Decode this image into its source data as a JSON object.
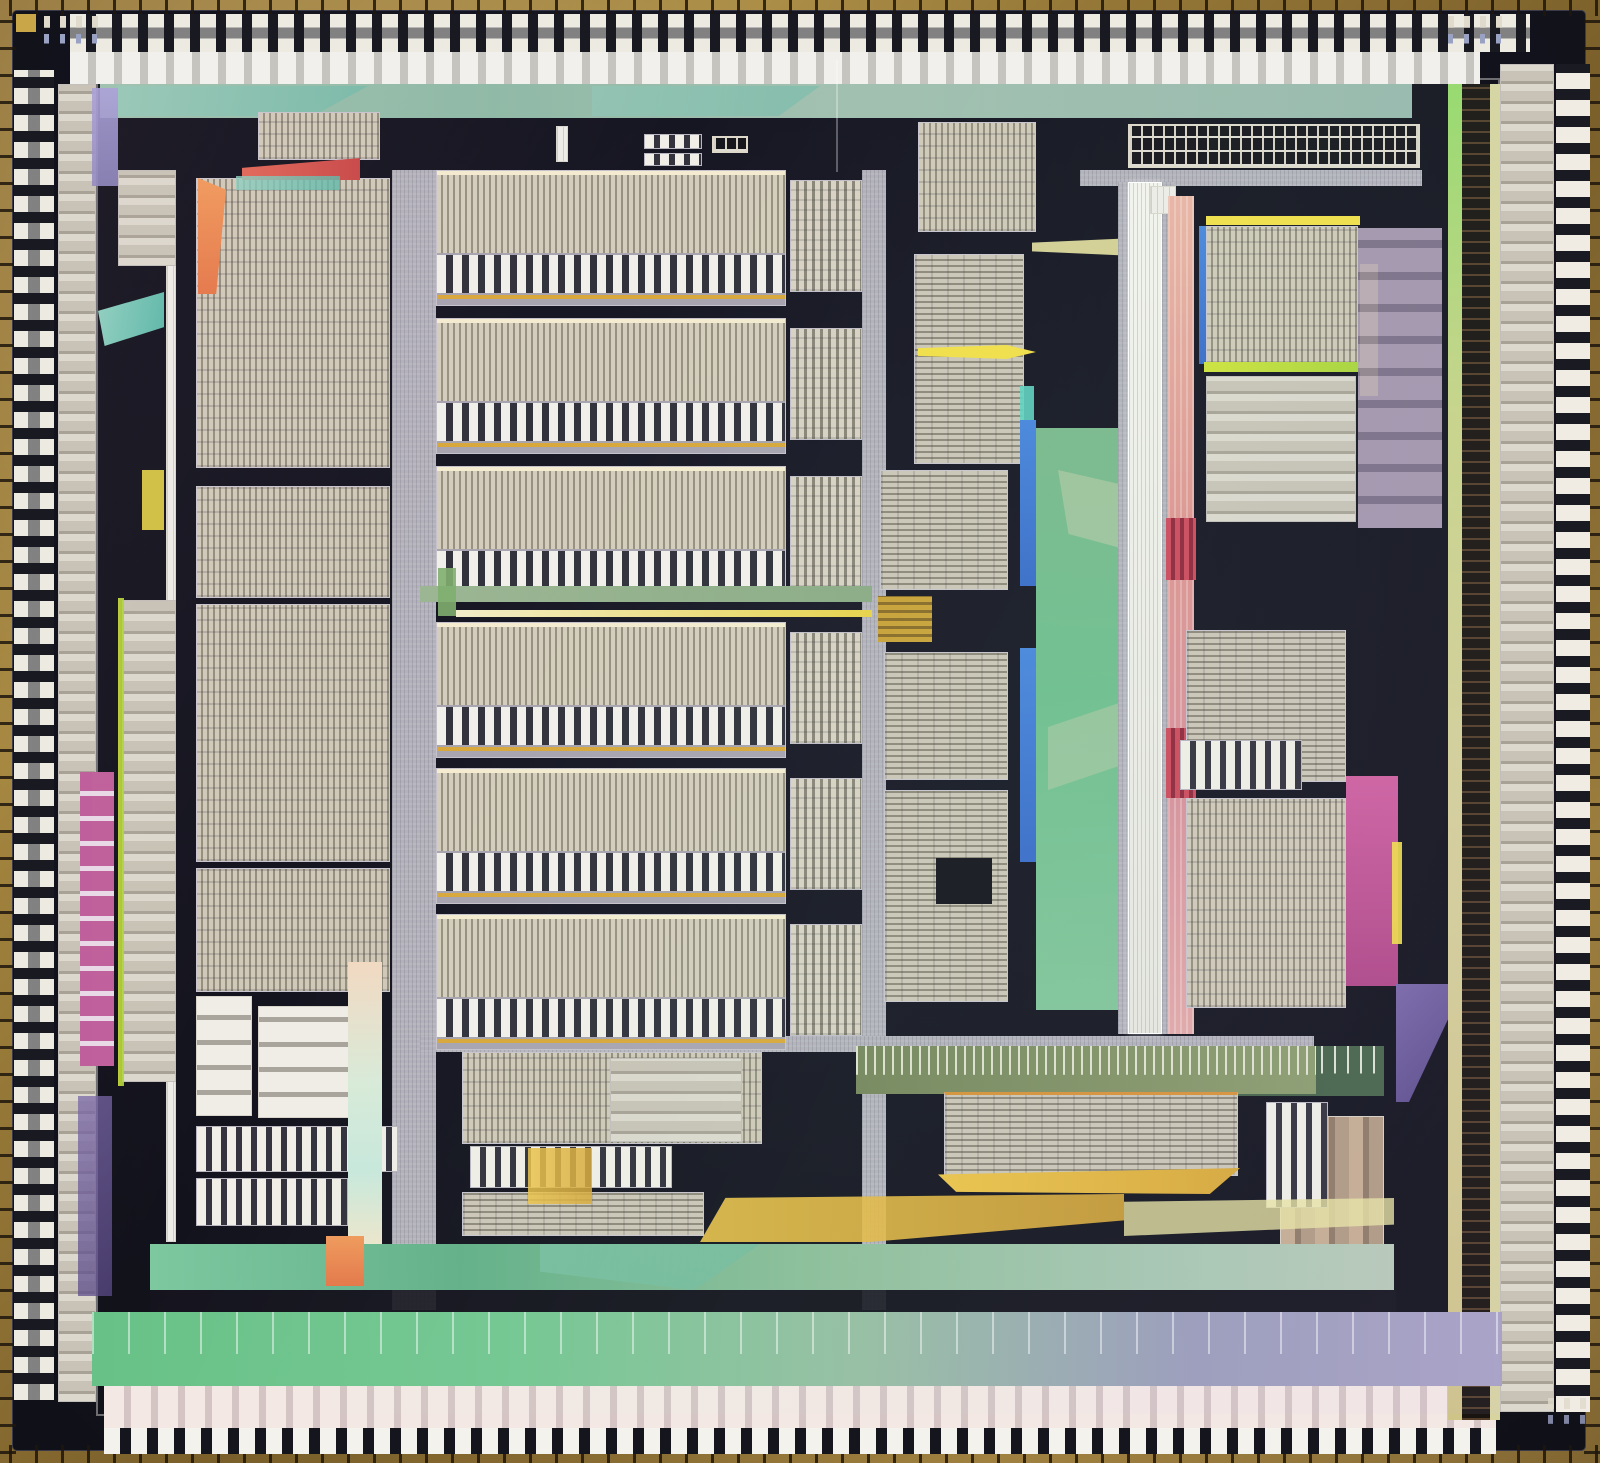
{
  "meta": {
    "alt": "Color photomicrograph of a microprocessor integrated-circuit die: gold chip edge with bond wires, perimeter bond-pad ring, dark substrate, rows of striped datapath and array blocks, a bright white vertical bus spine, and iridescent green, magenta, yellow and blue thin-film regions"
  },
  "palette": {
    "edge_gold": "#8a6d35",
    "die_dark": "#14141f",
    "block_tan": "#cdc6b6",
    "stripe_dark": "#8f897b",
    "channel_gray": "#b3b1bb",
    "spine_white": "#f2f1ec",
    "green": "#6fbe8e",
    "teal": "#5cb8a8",
    "sage": "#9cb694",
    "magenta": "#b0548c",
    "salmon": "#e09890",
    "crimson": "#cc4a5c",
    "yellow": "#f2df4a",
    "gold": "#d8a83a",
    "chartreuse": "#cfe23c",
    "orange": "#f09a5c",
    "blue": "#3f7bd9",
    "lavender": "#a8a0d8",
    "purple": "#6f5d9c",
    "olive": "#7a8a5c",
    "khaki": "#cfd98c",
    "pad_white": "#edeae2",
    "bond_wire": "#241c12"
  },
  "regions": [
    {
      "n": "top-power-band",
      "x": 100,
      "y": 84,
      "w": 1312,
      "h": 34,
      "c": "w-topband"
    },
    {
      "n": "top-band-facet",
      "x": 118,
      "y": 86,
      "w": 250,
      "h": 30,
      "c": "w-teal",
      "op": 0.45,
      "clip": "polygon(0 0,100% 0,78% 100%,0 100%)"
    },
    {
      "n": "top-band-facet",
      "x": 592,
      "y": 86,
      "w": 228,
      "h": 30,
      "c": "w-teal",
      "op": 0.4,
      "clip": "polygon(0 0,100% 0,82% 100%,0 100%)"
    },
    {
      "n": "left-inner-column",
      "x": 58,
      "y": 84,
      "w": 38,
      "h": 1318,
      "c": "t-cells"
    },
    {
      "n": "right-inner-column",
      "x": 1500,
      "y": 64,
      "w": 54,
      "h": 1348,
      "c": "t-cells"
    },
    {
      "n": "left-center-channel",
      "x": 392,
      "y": 170,
      "w": 44,
      "h": 1140,
      "c": "t-chan"
    },
    {
      "n": "center-right-channel",
      "x": 862,
      "y": 170,
      "w": 24,
      "h": 1140,
      "c": "t-chan"
    },
    {
      "n": "top-right-bar",
      "x": 1080,
      "y": 170,
      "w": 342,
      "h": 16,
      "c": "t-chan"
    },
    {
      "n": "bottom-channel",
      "x": 420,
      "y": 1036,
      "w": 894,
      "h": 16,
      "c": "t-chan"
    },
    {
      "n": "khaki-bus-left",
      "x": 1448,
      "y": 84,
      "w": 14,
      "h": 1336,
      "c": "t-khaki"
    },
    {
      "n": "right-dark-column",
      "x": 1462,
      "y": 84,
      "w": 28,
      "h": 1336,
      "c": "t-darkwire"
    },
    {
      "n": "khaki-bus-right",
      "x": 1490,
      "y": 84,
      "w": 10,
      "h": 1336,
      "c": "w-khaki2"
    },
    {
      "n": "left-bus-line",
      "x": 166,
      "y": 170,
      "w": 10,
      "h": 1072,
      "c": "t-white"
    },
    {
      "n": "cell-block",
      "x": 118,
      "y": 170,
      "w": 58,
      "h": 96,
      "c": "t-cells"
    },
    {
      "n": "array-block",
      "x": 196,
      "y": 178,
      "w": 194,
      "h": 290,
      "c": "t-vfine"
    },
    {
      "n": "array-block",
      "x": 196,
      "y": 486,
      "w": 194,
      "h": 112,
      "c": "t-vfine"
    },
    {
      "n": "array-block",
      "x": 196,
      "y": 604,
      "w": 194,
      "h": 258,
      "c": "t-vfine"
    },
    {
      "n": "array-block",
      "x": 196,
      "y": 868,
      "w": 194,
      "h": 124,
      "c": "t-vfine"
    },
    {
      "n": "cell-column",
      "x": 122,
      "y": 600,
      "w": 54,
      "h": 482,
      "c": "t-cells"
    },
    {
      "n": "yellow-bus",
      "x": 118,
      "y": 598,
      "w": 6,
      "h": 488,
      "c": "w-chartreuse",
      "op": 0.9
    },
    {
      "n": "magenta-comb",
      "x": 80,
      "y": 772,
      "w": 34,
      "h": 294,
      "c": "t-magcomb"
    },
    {
      "n": "purple-column",
      "x": 78,
      "y": 1096,
      "w": 34,
      "h": 200,
      "c": "w-purple",
      "op": 0.75
    },
    {
      "n": "white-stack",
      "x": 258,
      "y": 1006,
      "w": 94,
      "h": 112,
      "c": "t-stack"
    },
    {
      "n": "ladder-block",
      "x": 196,
      "y": 996,
      "w": 56,
      "h": 120,
      "c": "t-stack"
    },
    {
      "n": "comb-block",
      "x": 196,
      "y": 1126,
      "w": 202,
      "h": 46,
      "c": "t-comb8"
    },
    {
      "n": "comb-block",
      "x": 196,
      "y": 1178,
      "w": 152,
      "h": 48,
      "c": "t-comb8"
    },
    {
      "n": "pastel-strip",
      "x": 348,
      "y": 962,
      "w": 34,
      "h": 298,
      "c": "w-pastel"
    },
    {
      "n": "comb-block",
      "x": 258,
      "y": 112,
      "w": 122,
      "h": 48,
      "c": "t-vfine"
    },
    {
      "n": "red-wedge",
      "x": 242,
      "y": 158,
      "w": 118,
      "h": 22,
      "c": "w-red",
      "clip": "polygon(0 45%,100% 0,100% 100%,0 100%)"
    },
    {
      "n": "teal-wedge",
      "x": 236,
      "y": 176,
      "w": 104,
      "h": 14,
      "c": "w-teal",
      "op": 0.8
    },
    {
      "n": "orange-wedge",
      "x": 198,
      "y": 178,
      "w": 28,
      "h": 116,
      "c": "w-orange",
      "clip": "polygon(0 0,100% 10%,65% 100%,0 100%)"
    },
    {
      "n": "green-wedge",
      "x": 98,
      "y": 292,
      "w": 66,
      "h": 54,
      "c": "w-teal",
      "clip": "polygon(0 35%,100% 0,100% 65%,10% 100%)"
    },
    {
      "n": "yellow-patch",
      "x": 142,
      "y": 470,
      "w": 22,
      "h": 60,
      "c": "w-yellow",
      "op": 0.85
    },
    {
      "n": "violet-wedge",
      "x": 92,
      "y": 88,
      "w": 26,
      "h": 98,
      "c": "w-lavender",
      "op": 0.9
    },
    {
      "n": "datapath-block",
      "x": 436,
      "y": 170,
      "w": 350,
      "h": 136,
      "c": "t-unit"
    },
    {
      "n": "datapath-block",
      "x": 436,
      "y": 318,
      "w": 350,
      "h": 136,
      "c": "t-unit"
    },
    {
      "n": "datapath-block",
      "x": 436,
      "y": 466,
      "w": 350,
      "h": 136,
      "c": "t-unit"
    },
    {
      "n": "datapath-block",
      "x": 436,
      "y": 622,
      "w": 350,
      "h": 136,
      "c": "t-unit"
    },
    {
      "n": "datapath-block",
      "x": 436,
      "y": 768,
      "w": 350,
      "h": 136,
      "c": "t-unit"
    },
    {
      "n": "datapath-block",
      "x": 436,
      "y": 914,
      "w": 350,
      "h": 136,
      "c": "t-unit"
    },
    {
      "n": "side-block",
      "x": 790,
      "y": 180,
      "w": 72,
      "h": 112,
      "c": "t-side"
    },
    {
      "n": "side-block",
      "x": 790,
      "y": 328,
      "w": 72,
      "h": 112,
      "c": "t-side"
    },
    {
      "n": "side-block",
      "x": 790,
      "y": 476,
      "w": 72,
      "h": 112,
      "c": "t-side"
    },
    {
      "n": "side-block",
      "x": 790,
      "y": 632,
      "w": 72,
      "h": 112,
      "c": "t-side"
    },
    {
      "n": "side-block",
      "x": 790,
      "y": 778,
      "w": 72,
      "h": 112,
      "c": "t-side"
    },
    {
      "n": "side-block",
      "x": 790,
      "y": 924,
      "w": 72,
      "h": 112,
      "c": "t-side"
    },
    {
      "n": "green-channel",
      "x": 420,
      "y": 586,
      "w": 452,
      "h": 16,
      "c": "w-sagechan"
    },
    {
      "n": "warm-line",
      "x": 456,
      "y": 610,
      "w": 416,
      "h": 7,
      "c": "w-warmline"
    },
    {
      "n": "green-post",
      "x": 438,
      "y": 568,
      "w": 18,
      "h": 48,
      "c": "w-greenpost",
      "op": 0.9
    },
    {
      "n": "comb-block",
      "x": 918,
      "y": 122,
      "w": 118,
      "h": 110,
      "c": "t-vfine"
    },
    {
      "n": "array-block",
      "x": 914,
      "y": 254,
      "w": 110,
      "h": 210,
      "c": "t-hfine"
    },
    {
      "n": "yellow-arrow",
      "x": 918,
      "y": 336,
      "w": 118,
      "h": 32,
      "c": "w-yellow",
      "clip": "polygon(0 38%,75% 28%,100% 50%,75% 72%,0 62%)"
    },
    {
      "n": "teal-sliver",
      "x": 1020,
      "y": 386,
      "w": 14,
      "h": 80,
      "c": "w-tealbright",
      "op": 0.9
    },
    {
      "n": "blue-strip",
      "x": 1020,
      "y": 420,
      "w": 16,
      "h": 166,
      "c": "w-blue"
    },
    {
      "n": "blue-strip",
      "x": 1020,
      "y": 648,
      "w": 16,
      "h": 214,
      "c": "w-blue"
    },
    {
      "n": "green-column",
      "x": 1036,
      "y": 428,
      "w": 92,
      "h": 582,
      "c": "t-greencol"
    },
    {
      "n": "green-facet",
      "x": 1058,
      "y": 470,
      "w": 70,
      "h": 80,
      "c": "w-sage",
      "op": 0.6,
      "clip": "polygon(0 0,100% 20%,100% 100%,15% 80%)"
    },
    {
      "n": "green-facet",
      "x": 1048,
      "y": 700,
      "w": 80,
      "h": 90,
      "c": "w-sage",
      "op": 0.5,
      "clip": "polygon(0 30%,100% 0,100% 70%,0 100%)"
    },
    {
      "n": "yellow-beam",
      "x": 1032,
      "y": 236,
      "w": 150,
      "h": 22,
      "c": "w-paleyellow",
      "op": 0.9,
      "clip": "polygon(0 30%,100% 0,100% 100%,0 70%)"
    },
    {
      "n": "array-block",
      "x": 880,
      "y": 470,
      "w": 128,
      "h": 120,
      "c": "t-hfine"
    },
    {
      "n": "gold-detail",
      "x": 878,
      "y": 596,
      "w": 54,
      "h": 46,
      "c": "t-golddetail"
    },
    {
      "n": "array-block",
      "x": 884,
      "y": 652,
      "w": 124,
      "h": 128,
      "c": "t-hfine"
    },
    {
      "n": "array-block",
      "x": 884,
      "y": 790,
      "w": 124,
      "h": 212,
      "c": "t-hfine"
    },
    {
      "n": "dark-sub-block",
      "x": 936,
      "y": 858,
      "w": 56,
      "h": 46,
      "c": "t-dark"
    },
    {
      "n": "spine-rail",
      "x": 1118,
      "y": 182,
      "w": 10,
      "h": 852,
      "c": "t-chan"
    },
    {
      "n": "white-spine",
      "x": 1128,
      "y": 182,
      "w": 34,
      "h": 852,
      "c": "t-spine"
    },
    {
      "n": "spine-rail",
      "x": 1162,
      "y": 182,
      "w": 12,
      "h": 852,
      "c": "t-chan"
    },
    {
      "n": "rom-grid",
      "x": 1128,
      "y": 124,
      "w": 292,
      "h": 44,
      "c": "t-grid"
    },
    {
      "n": "white-posts",
      "x": 1150,
      "y": 186,
      "w": 26,
      "h": 28,
      "c": "t-white"
    },
    {
      "n": "salmon-column",
      "x": 1168,
      "y": 196,
      "w": 26,
      "h": 838,
      "c": "t-salmon"
    },
    {
      "n": "crimson-block",
      "x": 1166,
      "y": 518,
      "w": 30,
      "h": 62,
      "c": "t-crimson"
    },
    {
      "n": "crimson-block",
      "x": 1166,
      "y": 728,
      "w": 30,
      "h": 70,
      "c": "t-crimson"
    },
    {
      "n": "yellow-line",
      "x": 1206,
      "y": 216,
      "w": 154,
      "h": 9,
      "c": "w-yellow"
    },
    {
      "n": "blue-edge",
      "x": 1199,
      "y": 226,
      "w": 8,
      "h": 138,
      "c": "w-blue"
    },
    {
      "n": "array-block",
      "x": 1206,
      "y": 226,
      "w": 152,
      "h": 138,
      "c": "t-vfine"
    },
    {
      "n": "chartreuse-line",
      "x": 1204,
      "y": 362,
      "w": 158,
      "h": 10,
      "c": "w-chartreuse"
    },
    {
      "n": "yellow-strip",
      "x": 1360,
      "y": 264,
      "w": 18,
      "h": 132,
      "c": "w-yellow"
    },
    {
      "n": "cell-block",
      "x": 1206,
      "y": 376,
      "w": 150,
      "h": 146,
      "c": "t-cells"
    },
    {
      "n": "mauve-stack",
      "x": 1358,
      "y": 228,
      "w": 84,
      "h": 300,
      "c": "t-mauve",
      "op": 0.9
    },
    {
      "n": "array-block",
      "x": 1186,
      "y": 630,
      "w": 160,
      "h": 152,
      "c": "t-hfine"
    },
    {
      "n": "comb-block",
      "x": 1180,
      "y": 740,
      "w": 122,
      "h": 50,
      "c": "t-comb8"
    },
    {
      "n": "array-block",
      "x": 1186,
      "y": 798,
      "w": 160,
      "h": 210,
      "c": "t-vfine"
    },
    {
      "n": "magenta-patch",
      "x": 1346,
      "y": 776,
      "w": 52,
      "h": 210,
      "c": "w-magenta"
    },
    {
      "n": "yellow-sliver",
      "x": 1392,
      "y": 842,
      "w": 10,
      "h": 102,
      "c": "w-yellow",
      "op": 0.9
    },
    {
      "n": "purple-facet",
      "x": 1396,
      "y": 984,
      "w": 52,
      "h": 118,
      "c": "w-purple",
      "clip": "polygon(0 0,100% 0,100% 30%,25% 100%,0 100%)"
    },
    {
      "n": "pin-panel",
      "x": 1230,
      "y": 1046,
      "w": 154,
      "h": 50,
      "c": "t-pinpanel"
    },
    {
      "n": "column-block",
      "x": 1280,
      "y": 1116,
      "w": 104,
      "h": 136,
      "c": "t-tancol"
    },
    {
      "n": "olive-band",
      "x": 856,
      "y": 1046,
      "w": 460,
      "h": 48,
      "c": "t-olive"
    },
    {
      "n": "array-block",
      "x": 944,
      "y": 1092,
      "w": 294,
      "h": 84,
      "c": "t-hfine edge-orange"
    },
    {
      "n": "gold-wedge",
      "x": 938,
      "y": 1168,
      "w": 302,
      "h": 26,
      "c": "w-gold",
      "clip": "polygon(0 25%,100% 0,90% 100%,6% 92%)"
    },
    {
      "n": "array-block",
      "x": 462,
      "y": 1052,
      "w": 300,
      "h": 92,
      "c": "t-vfine"
    },
    {
      "n": "comb-block",
      "x": 470,
      "y": 1146,
      "w": 202,
      "h": 42,
      "c": "t-comb8"
    },
    {
      "n": "array-block",
      "x": 462,
      "y": 1192,
      "w": 242,
      "h": 44,
      "c": "t-hfine"
    },
    {
      "n": "gold-patch",
      "x": 528,
      "y": 1148,
      "w": 64,
      "h": 56,
      "c": "w-gold",
      "op": 0.85
    },
    {
      "n": "cell-block",
      "x": 610,
      "y": 1058,
      "w": 132,
      "h": 84,
      "c": "t-cells"
    },
    {
      "n": "comb-block",
      "x": 1266,
      "y": 1102,
      "w": 62,
      "h": 106,
      "c": "t-comb8"
    },
    {
      "n": "teal-wedge",
      "x": 428,
      "y": 1244,
      "w": 62,
      "h": 42,
      "c": "w-teal",
      "clip": "polygon(0 0,100% 50%,0 100%)"
    },
    {
      "n": "gold-triangle",
      "x": 700,
      "y": 1194,
      "w": 424,
      "h": 48,
      "c": "w-gold",
      "op": 0.9,
      "clip": "polygon(0 100%,6% 8%,100% 0,100% 55%,40% 100%)"
    },
    {
      "n": "pale-yellow-facet",
      "x": 1124,
      "y": 1198,
      "w": 270,
      "h": 38,
      "c": "w-paleyellow",
      "op": 0.8,
      "clip": "polygon(0 10%,100% 0,100% 70%,0 100%)"
    },
    {
      "n": "teal-band",
      "x": 150,
      "y": 1244,
      "w": 1244,
      "h": 46,
      "c": "w-tealband"
    },
    {
      "n": "teal-band-facet",
      "x": 540,
      "y": 1244,
      "w": 220,
      "h": 46,
      "c": "w-teal",
      "op": 0.35,
      "clip": "polygon(0 0,100% 0,70% 100%,0 60%)"
    },
    {
      "n": "orange-patch",
      "x": 326,
      "y": 1236,
      "w": 38,
      "h": 50,
      "c": "w-orange"
    },
    {
      "n": "black-band",
      "x": 150,
      "y": 1290,
      "w": 1246,
      "h": 24,
      "c": "t-dark",
      "op": 0.92
    },
    {
      "n": "bottom-gradient-band",
      "x": 92,
      "y": 1312,
      "w": 1410,
      "h": 74,
      "c": "t-bottomband"
    },
    {
      "n": "bottom-wires",
      "x": 92,
      "y": 1312,
      "w": 1410,
      "h": 42,
      "c": "t-wires",
      "op": 0.8
    },
    {
      "n": "mask-mark",
      "x": 556,
      "y": 126,
      "w": 12,
      "h": 36,
      "c": "t-white"
    },
    {
      "n": "test-structure",
      "x": 644,
      "y": 134,
      "w": 58,
      "h": 15,
      "c": "t-comb8"
    },
    {
      "n": "test-structure",
      "x": 644,
      "y": 153,
      "w": 58,
      "h": 13,
      "c": "t-comb8"
    },
    {
      "n": "test-structure",
      "x": 712,
      "y": 136,
      "w": 36,
      "h": 17,
      "c": "t-grid"
    },
    {
      "n": "fiducial-marks",
      "x": 44,
      "y": 16,
      "w": 64,
      "h": 28,
      "c": "t-fid"
    },
    {
      "n": "fiducial-marks",
      "x": 1448,
      "y": 16,
      "w": 64,
      "h": 28,
      "c": "t-fid"
    },
    {
      "n": "fiducial-marks",
      "x": 1548,
      "y": 1398,
      "w": 42,
      "h": 26,
      "c": "t-fid",
      "op": 0.8
    },
    {
      "n": "gold-pad-mark",
      "x": 16,
      "y": 14,
      "w": 20,
      "h": 18,
      "c": "w-goldpad"
    },
    {
      "n": "wire-bundle",
      "x": 836,
      "y": 60,
      "w": 34,
      "h": 112,
      "c": "t-wires",
      "op": 0.5
    }
  ]
}
